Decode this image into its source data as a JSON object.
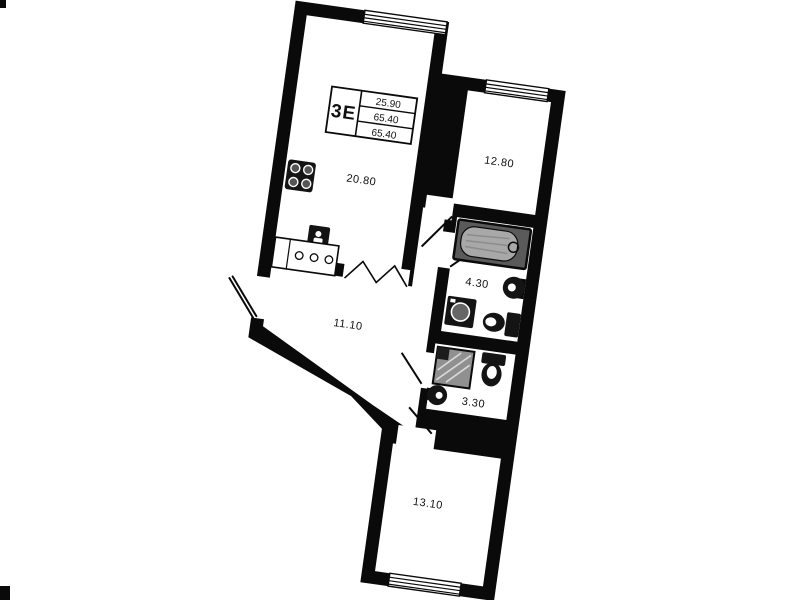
{
  "plan": {
    "unit": {
      "label": "3Е",
      "values": [
        "25.90",
        "65.40",
        "65.40"
      ]
    },
    "rooms": [
      {
        "name": "living-kitchen",
        "area": "20.80"
      },
      {
        "name": "bedroom-upper",
        "area": "12.80"
      },
      {
        "name": "bathroom",
        "area": "4.30"
      },
      {
        "name": "hallway",
        "area": "11.10"
      },
      {
        "name": "wc",
        "area": "3.30"
      },
      {
        "name": "bedroom-lower",
        "area": "13.10"
      }
    ],
    "colors": {
      "wall": "#0a0a0a",
      "floor": "#ffffff",
      "fixture_dark": "#141414",
      "fixture_gray": "#8f8f8f"
    }
  }
}
